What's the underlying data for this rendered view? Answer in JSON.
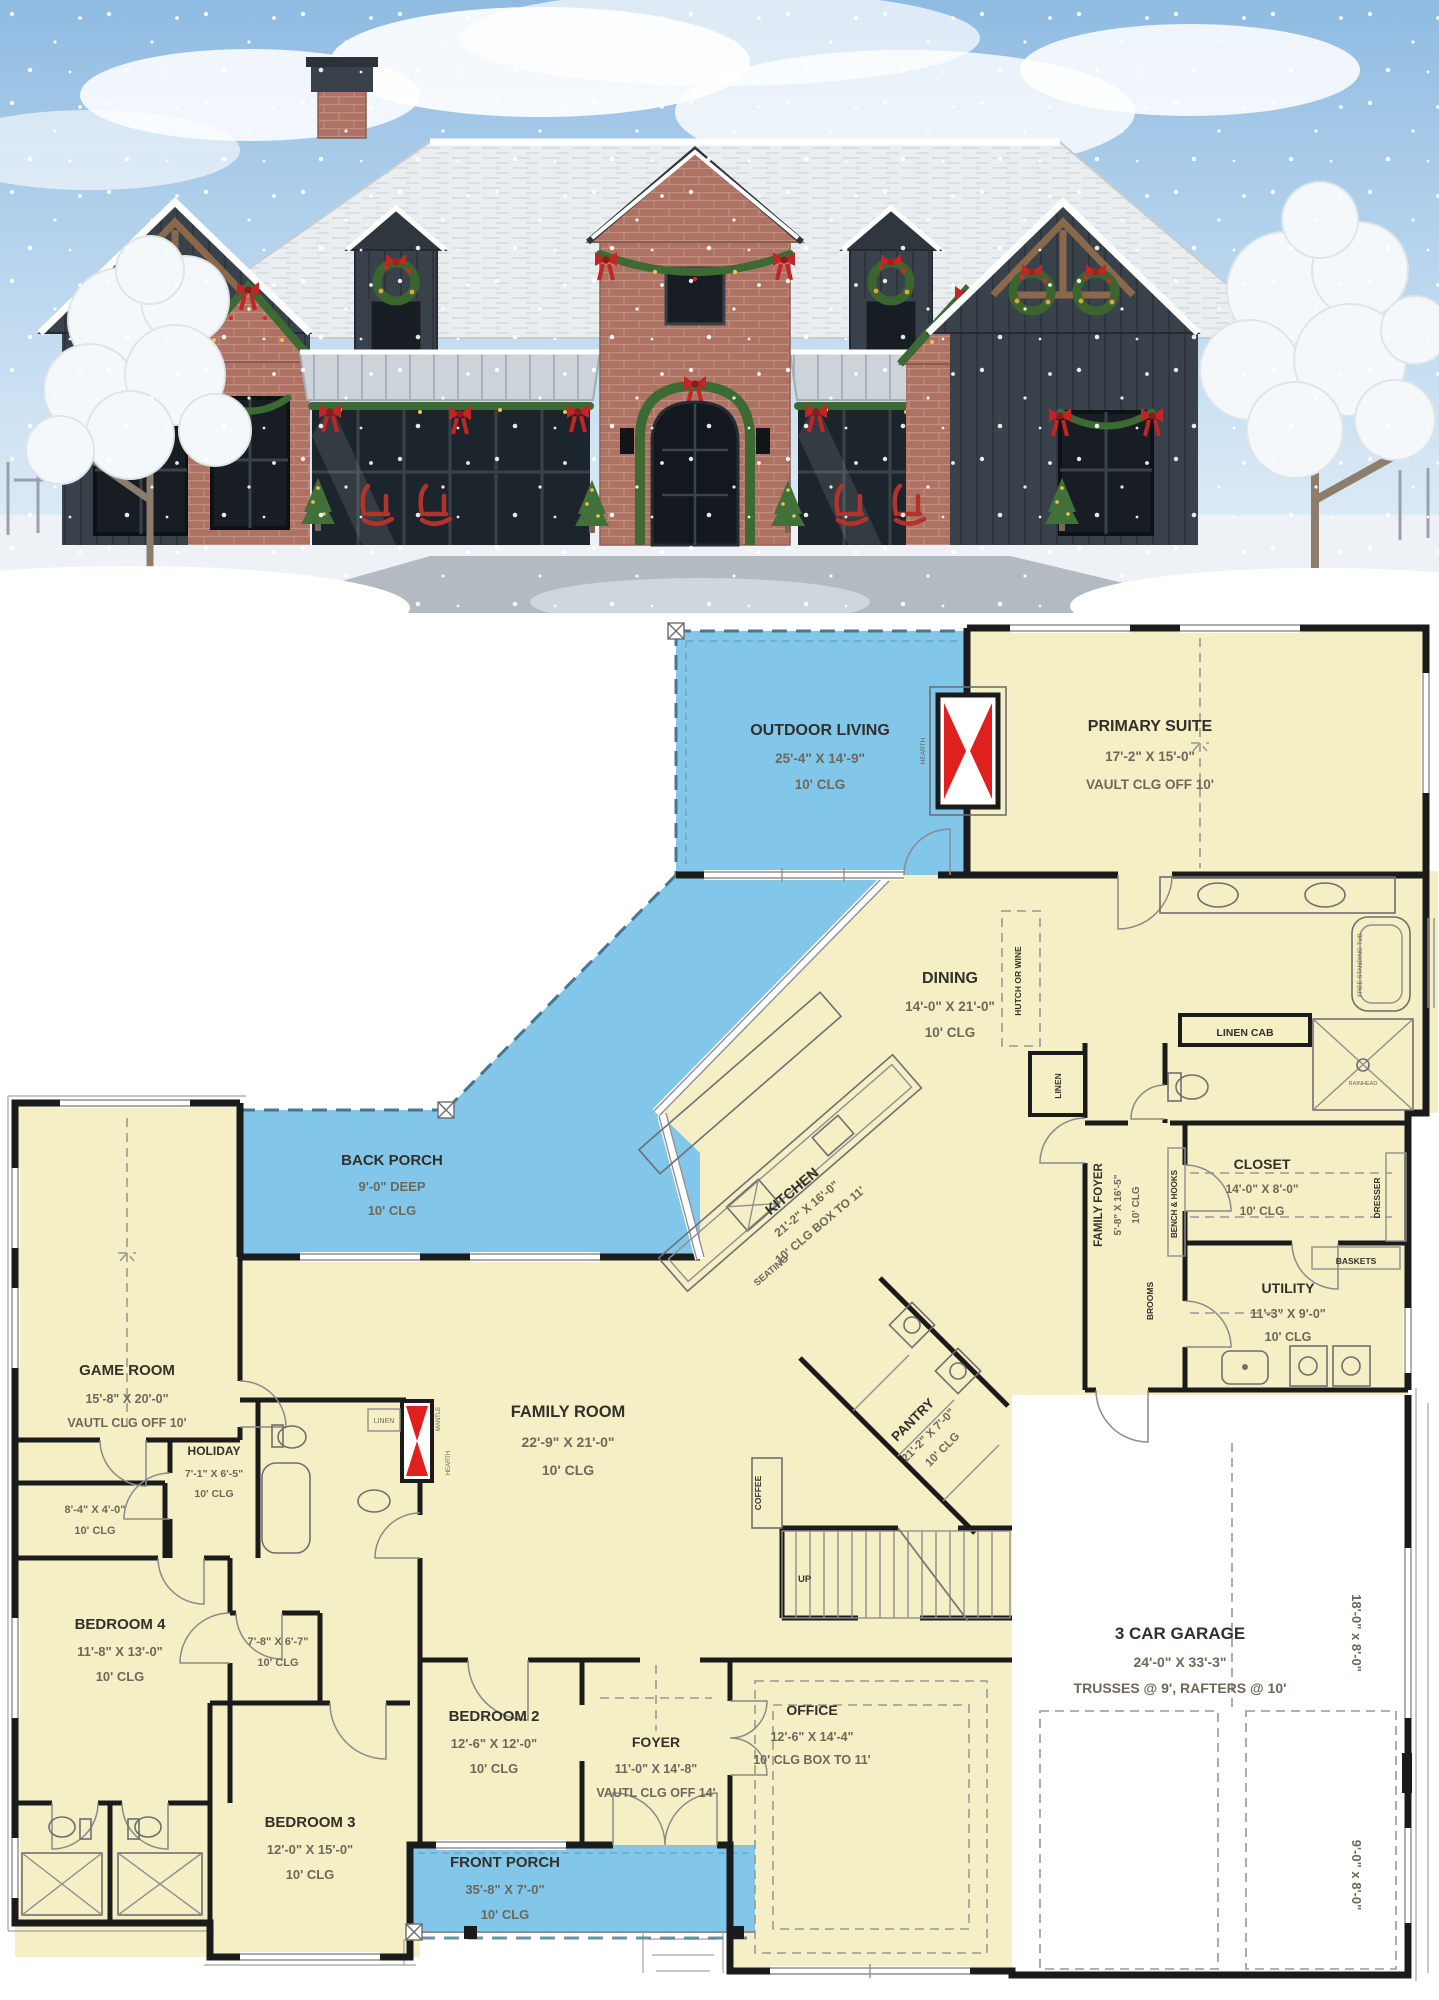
{
  "colors": {
    "room_fill": "#f5efc5",
    "porch_fill": "#82c6e9",
    "wall": "#1b1b1b",
    "fireplace_red": "#df201c",
    "label_dark": "#32302b",
    "label_dim": "#6d685a",
    "sky": "#9dc2e5",
    "roof_snow": "#eaeef1",
    "dark_siding": "#39414a",
    "brick": "#ad7263"
  },
  "plan": {
    "rooms": {
      "outdoor_living": {
        "name": "OUTDOOR LIVING",
        "dims": "25'-4\" X 14'-9\"",
        "clg": "10' CLG"
      },
      "primary_suite": {
        "name": "PRIMARY SUITE",
        "dims": "17'-2\" X 15'-0\"",
        "clg": "VAULT CLG OFF 10'"
      },
      "dining": {
        "name": "DINING",
        "dims": "14'-0\" X 21'-0\"",
        "clg": "10' CLG"
      },
      "back_porch": {
        "name": "BACK PORCH",
        "dims": "9'-0\" DEEP",
        "clg": "10' CLG"
      },
      "game_room": {
        "name": "GAME ROOM",
        "dims": "15'-8\" X 20'-0\"",
        "clg": "VAUTL CLG OFF 10'"
      },
      "kitchen": {
        "name": "KITCHEN",
        "dims": "21'-2\" X 16'-0\"",
        "clg": "10' CLG BOX TO 11'"
      },
      "family_foyer": {
        "name": "FAMILY FOYER",
        "dims": "5'-8\" X 16'-5\"",
        "clg": "10' CLG"
      },
      "closet": {
        "name": "CLOSET",
        "dims": "14'-0\" X 8'-0\"",
        "clg": "10' CLG"
      },
      "utility": {
        "name": "UTILITY",
        "dims": "11'-3\" X 9'-0\"",
        "clg": "10' CLG"
      },
      "family_room": {
        "name": "FAMILY ROOM",
        "dims": "22'-9\" X 21'-0\"",
        "clg": "10' CLG"
      },
      "holiday": {
        "name": "HOLIDAY",
        "dims": "7'-1\" X 6'-5\"",
        "clg": "10' CLG"
      },
      "pantry": {
        "name": "PANTRY",
        "dims": "21'-2\" X 7'-0\"",
        "clg": "10' CLG"
      },
      "closet_small_1": {
        "dims": "8'-4\" X 4'-0\"",
        "clg": "10' CLG"
      },
      "closet_small_2": {
        "dims": "7'-8\" X 6'-7\"",
        "clg": "10' CLG"
      },
      "bedroom_4": {
        "name": "BEDROOM 4",
        "dims": "11'-8\" X 13'-0\"",
        "clg": "10' CLG"
      },
      "bedroom_2": {
        "name": "BEDROOM 2",
        "dims": "12'-6\" X 12'-0\"",
        "clg": "10' CLG"
      },
      "bedroom_3": {
        "name": "BEDROOM 3",
        "dims": "12'-0\" X 15'-0\"",
        "clg": "10' CLG"
      },
      "foyer": {
        "name": "FOYER",
        "dims": "11'-0\" X 14'-8\"",
        "clg": "VAUTL CLG OFF 14'"
      },
      "office": {
        "name": "OFFICE",
        "dims": "12'-6\" X 14'-4\"",
        "clg": "10' CLG BOX TO 11'"
      },
      "garage": {
        "name": "3 CAR GARAGE",
        "dims": "24'-0\" X 33'-3\"",
        "clg": "TRUSSES @ 9', RAFTERS @ 10'"
      },
      "front_porch": {
        "name": "FRONT PORCH",
        "dims": "35'-8\" X 7'-0\"",
        "clg": "10' CLG"
      }
    },
    "labels": {
      "hutch_or_wine": "HUTCH OR WINE",
      "linen": "LINEN",
      "linen_cab": "LINEN CAB",
      "bench_hooks": "BENCH & HOOKS",
      "brooms": "BROOMS",
      "baskets": "BASKETS",
      "dresser": "DRESSER",
      "free_standing_tub": "FREE STANDING TUB",
      "rainhead": "RAINHEAD",
      "seating": "SEATING",
      "coffee": "COFFEE",
      "up": "UP",
      "hearth": "HEARTH",
      "mantle": "MANTLE",
      "garage_door_large": "18'-0\" x 8'-0\"",
      "garage_door_small": "9'-0\" x 8'-0\""
    }
  }
}
